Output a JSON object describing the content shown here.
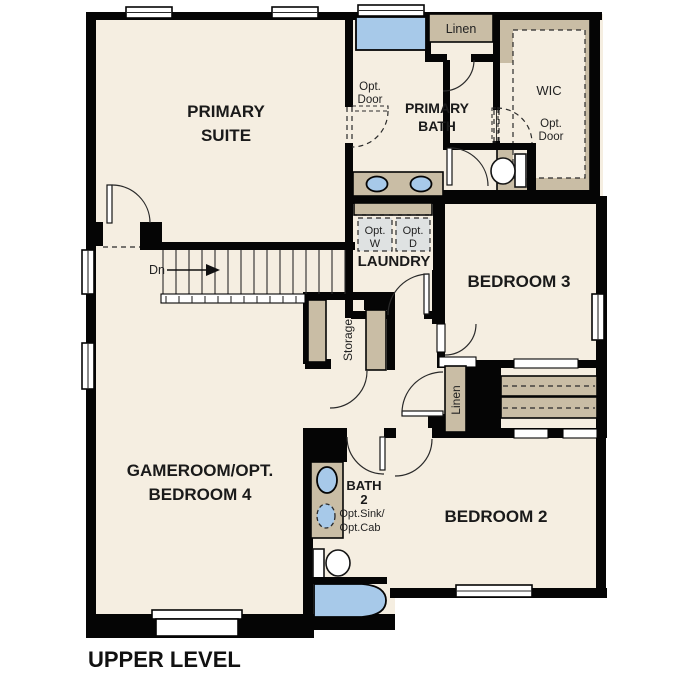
{
  "title": "UPPER LEVEL",
  "rooms": {
    "primary_suite": {
      "l1": "PRIMARY",
      "l2": "SUITE"
    },
    "primary_bath": {
      "l1": "PRIMARY",
      "l2": "BATH"
    },
    "wic": "WIC",
    "laundry": "LAUNDRY",
    "bedroom3": "BEDROOM 3",
    "bedroom2": "BEDROOM 2",
    "gameroom": {
      "l1": "GAMEROOM/OPT.",
      "l2": "BEDROOM 4"
    },
    "bath2": {
      "l1": "BATH",
      "l2": "2"
    }
  },
  "labels": {
    "linen_top": "Linen",
    "linen_hall": "Linen",
    "storage": "Storage",
    "dn": "Dn",
    "opt_door_bath": {
      "l1": "Opt.",
      "l2": "Door"
    },
    "opt_door_wic": {
      "l1": "Opt.",
      "l2": "Door"
    },
    "opt_w": {
      "l1": "Opt.",
      "l2": "W"
    },
    "opt_d": {
      "l1": "Opt.",
      "l2": "D"
    },
    "opt_sink": {
      "l1": "Opt.Sink/",
      "l2": "Opt.Cab"
    }
  },
  "colors": {
    "floor": "#f5eee1",
    "wall": "#050505",
    "casework_tan": "#c9bda5",
    "fixture_blue": "#a7c9e9",
    "appliance_gray": "#dfe2e2",
    "text": "#1a1a1a"
  }
}
